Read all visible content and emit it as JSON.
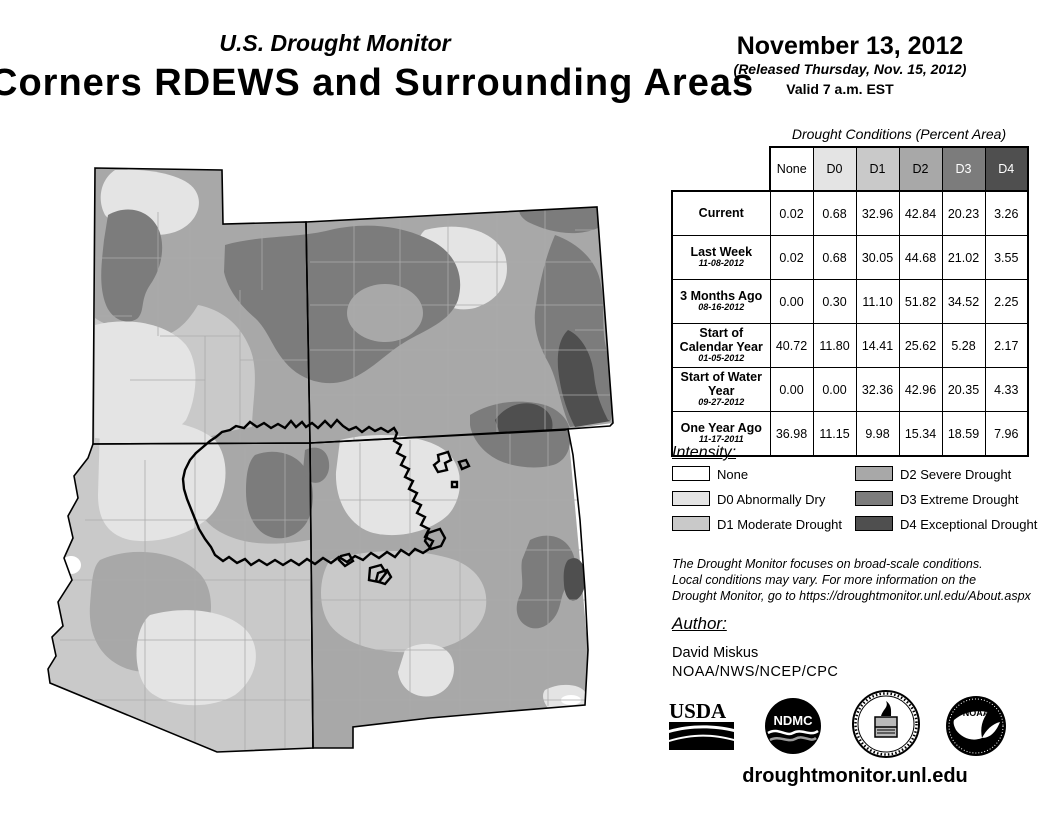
{
  "header": {
    "program_title": "U.S. Drought Monitor",
    "region_title": "Corners RDEWS and Surrounding Areas",
    "date": "November 13, 2012",
    "released": "(Released Thursday, Nov. 15, 2012)",
    "valid": "Valid 7 a.m. EST"
  },
  "table": {
    "caption": "Drought Conditions (Percent Area)",
    "columns": [
      "None",
      "D0",
      "D1",
      "D2",
      "D3",
      "D4"
    ],
    "rows": [
      {
        "label": "Current",
        "date": "",
        "values": [
          "0.02",
          "0.68",
          "32.96",
          "42.84",
          "20.23",
          "3.26"
        ]
      },
      {
        "label": "Last Week",
        "date": "11-08-2012",
        "values": [
          "0.02",
          "0.68",
          "30.05",
          "44.68",
          "21.02",
          "3.55"
        ]
      },
      {
        "label": "3 Months Ago",
        "date": "08-16-2012",
        "values": [
          "0.00",
          "0.30",
          "11.10",
          "51.82",
          "34.52",
          "2.25"
        ]
      },
      {
        "label": "Start of Calendar Year",
        "date": "01-05-2012",
        "values": [
          "40.72",
          "11.80",
          "14.41",
          "25.62",
          "5.28",
          "2.17"
        ]
      },
      {
        "label": "Start of Water Year",
        "date": "09-27-2012",
        "values": [
          "0.00",
          "0.00",
          "32.36",
          "42.96",
          "20.35",
          "4.33"
        ]
      },
      {
        "label": "One Year Ago",
        "date": "11-17-2011",
        "values": [
          "36.98",
          "11.15",
          "9.98",
          "15.34",
          "18.59",
          "7.96"
        ]
      }
    ]
  },
  "legend": {
    "heading": "Intensity:",
    "items": [
      {
        "code": "None",
        "label": "None"
      },
      {
        "code": "D0",
        "label": "D0 Abnormally Dry"
      },
      {
        "code": "D1",
        "label": "D1 Moderate Drought"
      },
      {
        "code": "D2",
        "label": "D2 Severe Drought"
      },
      {
        "code": "D3",
        "label": "D3 Extreme Drought"
      },
      {
        "code": "D4",
        "label": "D4 Exceptional Drought"
      }
    ]
  },
  "palette": {
    "None": "#FFFFFF",
    "D0": "#E4E4E4",
    "D1": "#C9C9C9",
    "D2": "#A8A8A8",
    "D3": "#7C7C7C",
    "D4": "#4F4F4F"
  },
  "disclaimer": {
    "line1": "The Drought Monitor focuses on broad-scale conditions.",
    "line2": "Local conditions may vary. For more information on the",
    "line3": "Drought Monitor, go to https://droughtmonitor.unl.edu/About.aspx"
  },
  "author": {
    "heading": "Author:",
    "name": "David Miskus",
    "org": "NOAA/NWS/NCEP/CPC"
  },
  "footer": {
    "site": "droughtmonitor.unl.edu",
    "usda_label": "USDA",
    "ndmc_label": "NDMC",
    "noaa_label": "NOAA"
  }
}
